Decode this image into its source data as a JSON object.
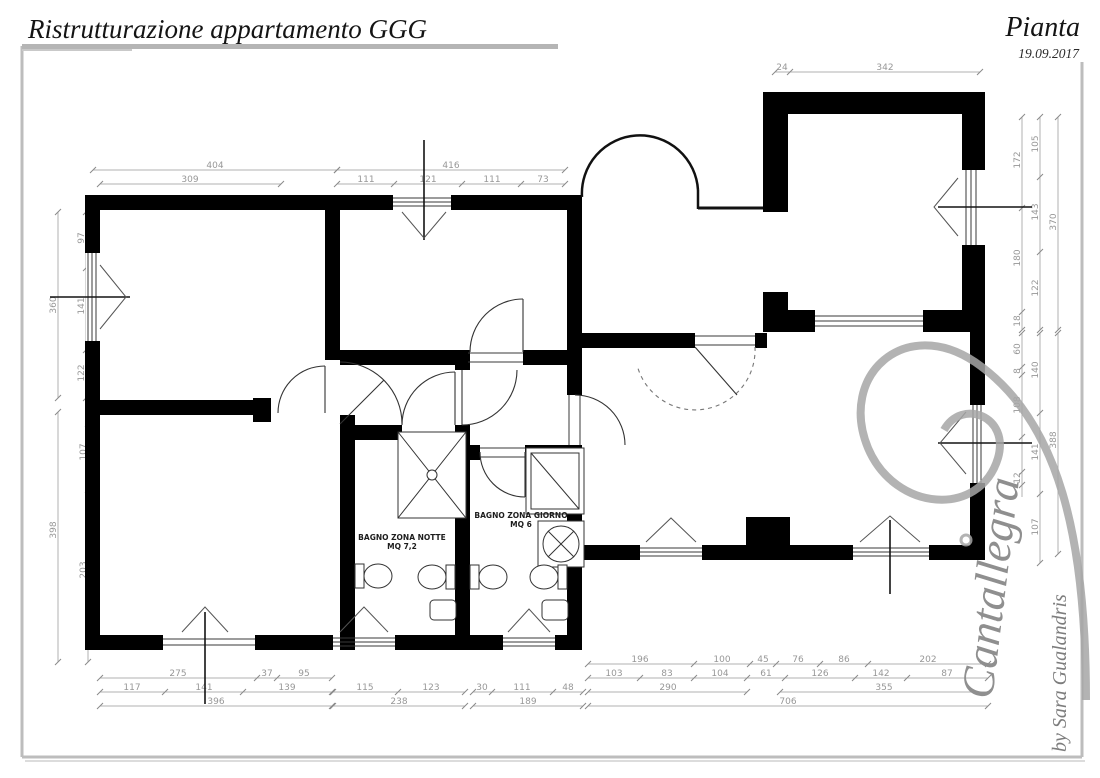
{
  "header": {
    "title": "Ristrutturazione appartamento GGG",
    "sheet": "Pianta",
    "date": "19.09.2017"
  },
  "rooms": [
    {
      "name": "BAGNO ZONA NOTTE",
      "area": "MQ 7,2",
      "x": 402,
      "y": 540
    },
    {
      "name": "BAGNO ZONA GIORNO",
      "area": "MQ 6",
      "x": 521,
      "y": 518
    }
  ],
  "signature": {
    "brand": "Cantallegra",
    "byline": "by Sara Gualandris"
  },
  "dim_chains": [
    {
      "dir": "h",
      "y": 170,
      "x1": 93,
      "x2": 337,
      "ticks": [
        93,
        337
      ],
      "labels": [
        {
          "v": "404",
          "p": 215
        }
      ]
    },
    {
      "dir": "h",
      "y": 184,
      "x1": 100,
      "x2": 281,
      "ticks": [
        100,
        281
      ],
      "labels": [
        {
          "v": "309",
          "p": 190
        }
      ]
    },
    {
      "dir": "h",
      "y": 170,
      "x1": 337,
      "x2": 565,
      "ticks": [
        337,
        565
      ],
      "labels": [
        {
          "v": "416",
          "p": 451
        }
      ]
    },
    {
      "dir": "h",
      "y": 184,
      "x1": 337,
      "x2": 565,
      "ticks": [
        337,
        394,
        462,
        521,
        565
      ],
      "labels": [
        {
          "v": "111",
          "p": 366
        },
        {
          "v": "121",
          "p": 428
        },
        {
          "v": "111",
          "p": 492
        },
        {
          "v": "73",
          "p": 543
        }
      ]
    },
    {
      "dir": "h",
      "y": 72,
      "x1": 775,
      "x2": 980,
      "ticks": [
        775,
        790,
        980
      ],
      "labels": [
        {
          "v": "24",
          "p": 782
        },
        {
          "v": "342",
          "p": 885
        }
      ]
    },
    {
      "dir": "h",
      "y": 678,
      "x1": 100,
      "x2": 332,
      "ticks": [
        100,
        257,
        277,
        332
      ],
      "labels": [
        {
          "v": "275",
          "p": 178
        },
        {
          "v": "37",
          "p": 267
        },
        {
          "v": "95",
          "p": 304
        }
      ]
    },
    {
      "dir": "h",
      "y": 692,
      "x1": 100,
      "x2": 332,
      "ticks": [
        100,
        165,
        243,
        332
      ],
      "labels": [
        {
          "v": "117",
          "p": 132
        },
        {
          "v": "141",
          "p": 204
        },
        {
          "v": "139",
          "p": 287
        }
      ]
    },
    {
      "dir": "h",
      "y": 706,
      "x1": 100,
      "x2": 332,
      "ticks": [
        100,
        332
      ],
      "labels": [
        {
          "v": "396",
          "p": 216
        }
      ]
    },
    {
      "dir": "h",
      "y": 692,
      "x1": 333,
      "x2": 465,
      "ticks": [
        333,
        398,
        465
      ],
      "labels": [
        {
          "v": "115",
          "p": 365
        },
        {
          "v": "123",
          "p": 431
        }
      ]
    },
    {
      "dir": "h",
      "y": 706,
      "x1": 333,
      "x2": 465,
      "ticks": [
        333,
        465
      ],
      "labels": [
        {
          "v": "238",
          "p": 399
        }
      ]
    },
    {
      "dir": "h",
      "y": 692,
      "x1": 473,
      "x2": 583,
      "ticks": [
        473,
        492,
        553,
        583
      ],
      "labels": [
        {
          "v": "30",
          "p": 482
        },
        {
          "v": "111",
          "p": 522
        },
        {
          "v": "48",
          "p": 568
        }
      ]
    },
    {
      "dir": "h",
      "y": 706,
      "x1": 473,
      "x2": 583,
      "ticks": [
        473,
        583
      ],
      "labels": [
        {
          "v": "189",
          "p": 528
        }
      ]
    },
    {
      "dir": "h",
      "y": 664,
      "x1": 588,
      "x2": 988,
      "ticks": [
        588,
        694,
        750,
        776,
        820,
        868,
        988
      ],
      "labels": [
        {
          "v": "196",
          "p": 640
        },
        {
          "v": "100",
          "p": 722
        },
        {
          "v": "45",
          "p": 763
        },
        {
          "v": "76",
          "p": 798
        },
        {
          "v": "86",
          "p": 844
        },
        {
          "v": "202",
          "p": 928
        }
      ]
    },
    {
      "dir": "h",
      "y": 678,
      "x1": 588,
      "x2": 988,
      "ticks": [
        588,
        640,
        694,
        747,
        785,
        855,
        907,
        988
      ],
      "labels": [
        {
          "v": "103",
          "p": 614
        },
        {
          "v": "83",
          "p": 667
        },
        {
          "v": "104",
          "p": 720
        },
        {
          "v": "61",
          "p": 766
        },
        {
          "v": "126",
          "p": 820
        },
        {
          "v": "142",
          "p": 881
        },
        {
          "v": "87",
          "p": 947
        }
      ]
    },
    {
      "dir": "h",
      "y": 692,
      "x1": 588,
      "x2": 747,
      "ticks": [
        588,
        747
      ],
      "labels": [
        {
          "v": "290",
          "p": 668
        }
      ]
    },
    {
      "dir": "h",
      "y": 692,
      "x1": 780,
      "x2": 988,
      "ticks": [
        780,
        988
      ],
      "labels": [
        {
          "v": "355",
          "p": 884
        }
      ]
    },
    {
      "dir": "h",
      "y": 706,
      "x1": 588,
      "x2": 988,
      "ticks": [
        588,
        988
      ],
      "labels": [
        {
          "v": "706",
          "p": 788
        }
      ]
    },
    {
      "dir": "v",
      "x": 58,
      "y1": 212,
      "y2": 398,
      "ticks": [
        212,
        398
      ],
      "labels": [
        {
          "v": "360",
          "p": 305
        }
      ]
    },
    {
      "dir": "v",
      "x": 86,
      "y1": 212,
      "y2": 398,
      "ticks": [
        212,
        268,
        350,
        398
      ],
      "labels": [
        {
          "v": "97",
          "p": 238
        },
        {
          "v": "141",
          "p": 306
        },
        {
          "v": "122",
          "p": 373
        }
      ]
    },
    {
      "dir": "v",
      "x": 58,
      "y1": 412,
      "y2": 662,
      "ticks": [
        412,
        662
      ],
      "labels": [
        {
          "v": "398",
          "p": 530
        }
      ]
    },
    {
      "dir": "v",
      "x": 88,
      "y1": 424,
      "y2": 662,
      "ticks": [
        424,
        490,
        662
      ],
      "labels": [
        {
          "v": "107",
          "p": 452
        },
        {
          "v": "203",
          "p": 570
        }
      ]
    },
    {
      "dir": "v",
      "x": 1022,
      "y1": 117,
      "y2": 330,
      "ticks": [
        117,
        208,
        312,
        330
      ],
      "labels": [
        {
          "v": "172",
          "p": 160
        },
        {
          "v": "180",
          "p": 258
        },
        {
          "v": "18",
          "p": 321
        }
      ]
    },
    {
      "dir": "v",
      "x": 1040,
      "y1": 117,
      "y2": 330,
      "ticks": [
        117,
        177,
        252,
        330
      ],
      "labels": [
        {
          "v": "105",
          "p": 144
        },
        {
          "v": "143",
          "p": 212
        },
        {
          "v": "122",
          "p": 288
        }
      ]
    },
    {
      "dir": "v",
      "x": 1058,
      "y1": 117,
      "y2": 330,
      "ticks": [
        117,
        330
      ],
      "labels": [
        {
          "v": "370",
          "p": 222
        }
      ]
    },
    {
      "dir": "v",
      "x": 1022,
      "y1": 333,
      "y2": 497,
      "ticks": [
        333,
        367,
        375,
        437,
        472,
        485
      ],
      "labels": [
        {
          "v": "60",
          "p": 349
        },
        {
          "v": "8",
          "p": 371
        },
        {
          "v": "108",
          "p": 405
        },
        {
          "v": "12",
          "p": 478
        }
      ]
    },
    {
      "dir": "v",
      "x": 1040,
      "y1": 333,
      "y2": 563,
      "ticks": [
        333,
        413,
        494,
        563
      ],
      "labels": [
        {
          "v": "140",
          "p": 370
        },
        {
          "v": "141",
          "p": 452
        },
        {
          "v": "107",
          "p": 527
        }
      ]
    },
    {
      "dir": "v",
      "x": 1058,
      "y1": 333,
      "y2": 554,
      "ticks": [
        333,
        554
      ],
      "labels": [
        {
          "v": "388",
          "p": 440
        }
      ]
    }
  ]
}
